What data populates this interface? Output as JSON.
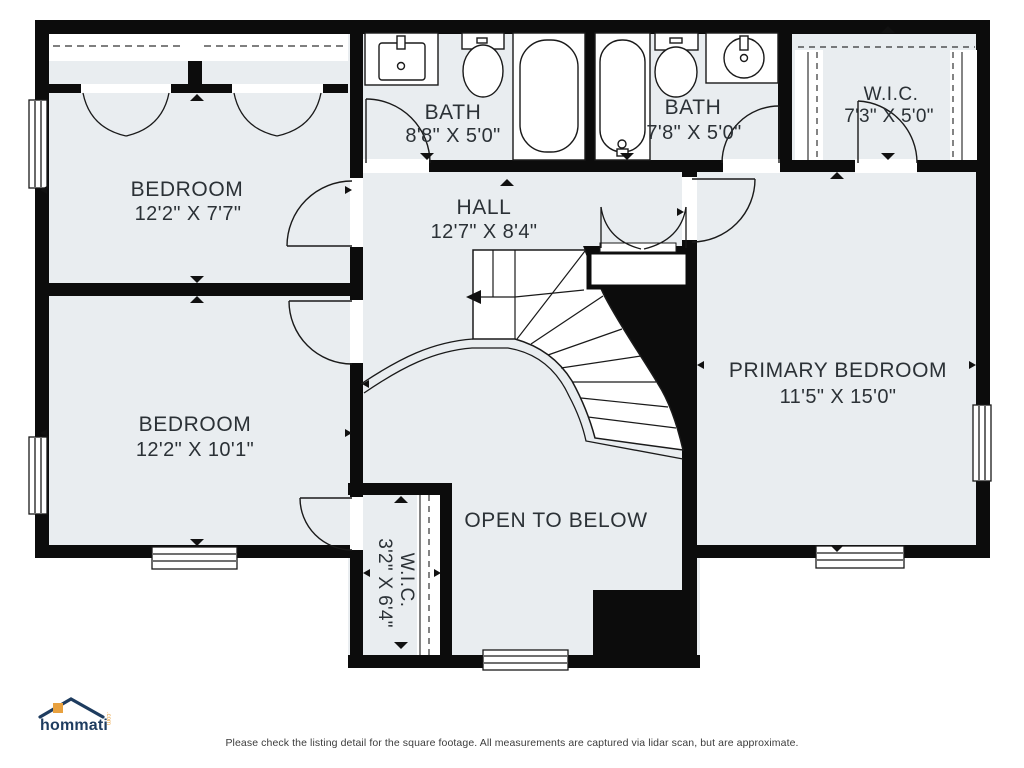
{
  "rooms": {
    "bedroom_top": {
      "name": "BEDROOM",
      "dims": "12'2\" X 7'7\""
    },
    "bedroom_bottom": {
      "name": "BEDROOM",
      "dims": "12'2\" X 10'1\""
    },
    "bath_left": {
      "name": "BATH",
      "dims": "8'8\" X 5'0\""
    },
    "bath_right": {
      "name": "BATH",
      "dims": "7'8\" X 5'0\""
    },
    "wic_top": {
      "name": "W.I.C.",
      "dims": "7'3\" X 5'0\""
    },
    "hall": {
      "name": "HALL",
      "dims": "12'7\" X 8'4\""
    },
    "primary": {
      "name": "PRIMARY BEDROOM",
      "dims": "11'5\" X 15'0\""
    },
    "wic_bottom": {
      "name": "W.I.C.",
      "dims": "3'2\" X 6'4\""
    },
    "open_below": {
      "name": "OPEN TO BELOW"
    }
  },
  "logo": {
    "brand": "hommati",
    "tld": ".com"
  },
  "footer": {
    "disclaimer": "Please check the listing detail for the square footage. All measurements are captured via lidar scan, but are approximate."
  },
  "colors": {
    "room_fill": "#e9edf0",
    "wall": "#0c0c0c",
    "text": "#2b3136",
    "accent": "#e8a13f",
    "brand_navy": "#1e3c5f"
  }
}
